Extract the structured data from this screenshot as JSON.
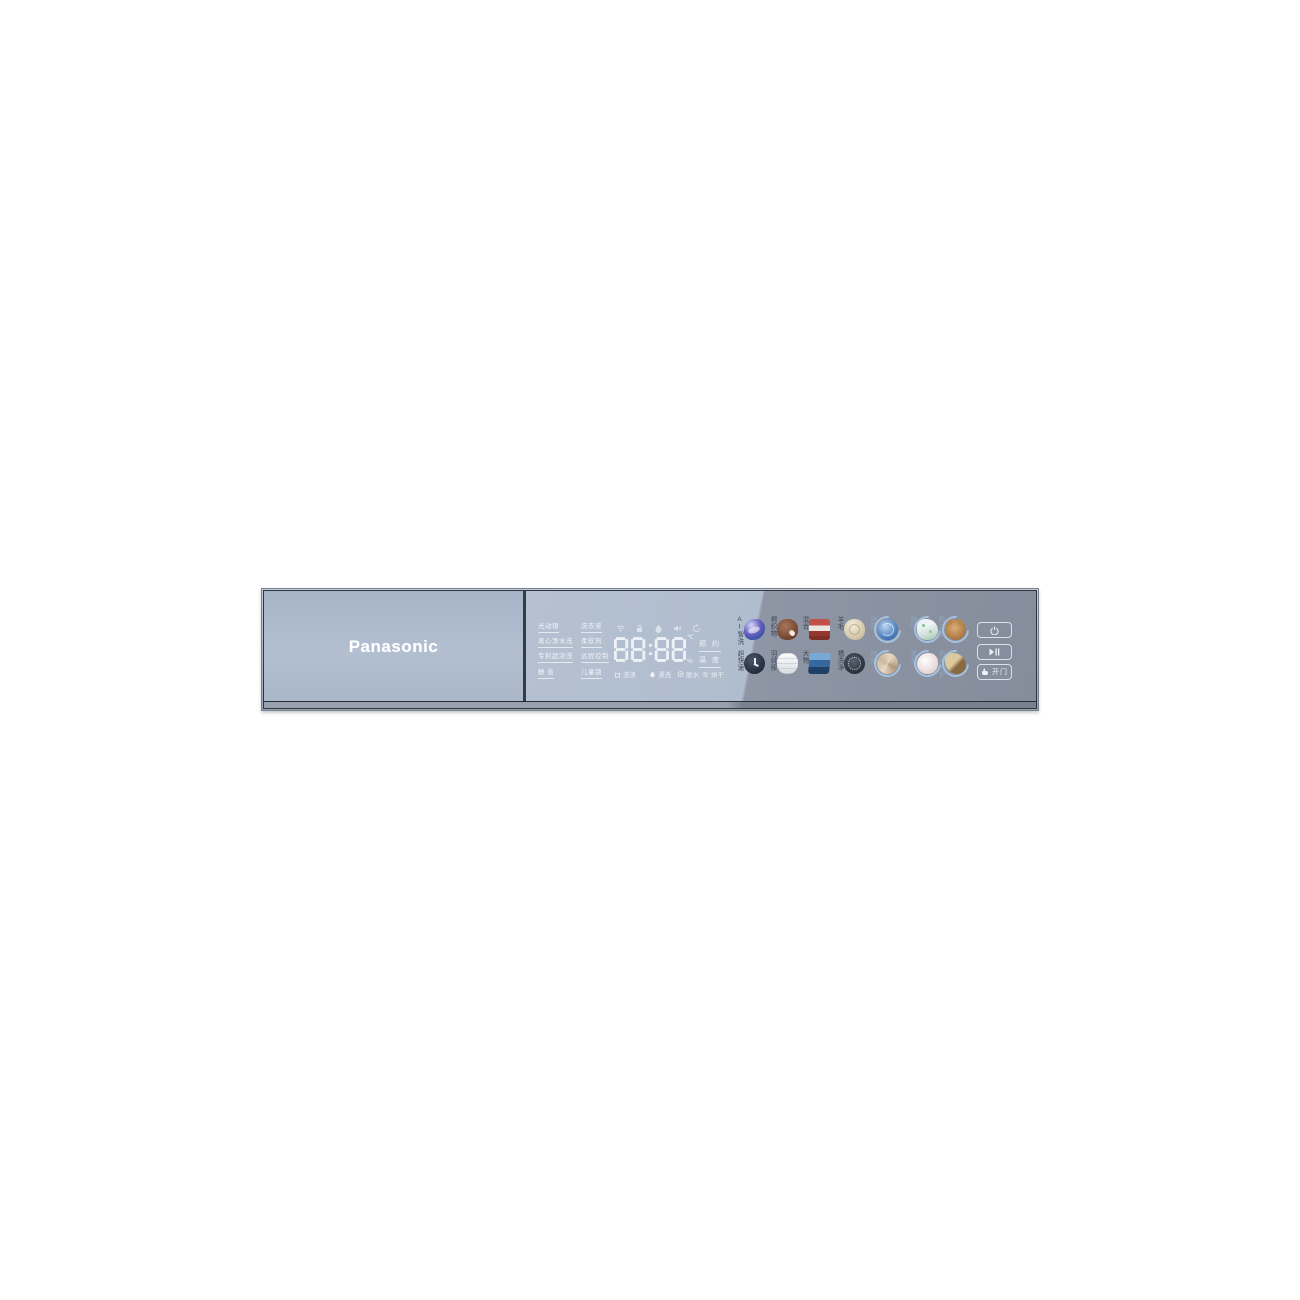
{
  "brand": "Panasonic",
  "panel": {
    "status_col1": [
      "光动银",
      "离心净水洗",
      "专利超浓洗",
      "静 音"
    ],
    "status_col2": [
      "洗衣液",
      "柔软剂",
      "远程控制",
      "儿童锁"
    ],
    "indicator_icons": [
      "wifi",
      "lock",
      "drop",
      "mute",
      "cycle"
    ],
    "display": {
      "time": "88:88",
      "temp_unit": "℃",
      "percent_unit": "%"
    },
    "side_keys": [
      {
        "label": "预 约"
      },
      {
        "label": "温 度"
      }
    ],
    "stages": [
      {
        "icon": "wash",
        "label": "洗涤"
      },
      {
        "icon": "rinse",
        "label": "漂洗"
      },
      {
        "icon": "spin",
        "label": "脱水"
      },
      {
        "icon": "dry",
        "label": "烘干"
      }
    ],
    "programs_row1": [
      {
        "label": "AI智洗",
        "icon": "ai-wash",
        "arc": false
      },
      {
        "label": "棉织物",
        "icon": "cotton",
        "arc": false
      },
      {
        "label": "混合",
        "icon": "mixed",
        "arc": false
      },
      {
        "label": "羊毛",
        "icon": "wool",
        "arc": false
      },
      {
        "label": "除菌",
        "icon": "sterilize",
        "arc": true
      },
      {
        "label": "除味",
        "icon": "deodorize",
        "arc": true
      },
      {
        "label": "防过敏",
        "icon": "anti-allergy",
        "arc": true
      }
    ],
    "programs_row2": [
      {
        "label": "超快速",
        "icon": "quick",
        "arc": false
      },
      {
        "label": "羽绒服",
        "icon": "down-jacket",
        "arc": false
      },
      {
        "label": "大物",
        "icon": "large-items",
        "arc": false
      },
      {
        "label": "槽洗净",
        "icon": "drum-clean",
        "arc": false
      },
      {
        "label": "除皱",
        "icon": "de-wrinkle",
        "arc": true
      },
      {
        "label": "蓬松",
        "icon": "fluff",
        "arc": true
      },
      {
        "label": "毛皮养护",
        "icon": "fur-care",
        "arc": true
      }
    ],
    "buttons": {
      "power": {
        "icon": "power"
      },
      "start_pause": {
        "icon": "play-pause"
      },
      "open_door": {
        "icon": "hand",
        "label": "开门"
      }
    }
  },
  "colors": {
    "glass_light": "#b2bfd1",
    "glass_dark": "#8e96a5",
    "frame_dark": "#2f3540",
    "text_light": "#f4f8fc",
    "program_label_dark": "#3f4754",
    "program_label_light": "#93a7c2",
    "arc_blue": "#a8c4e3"
  }
}
